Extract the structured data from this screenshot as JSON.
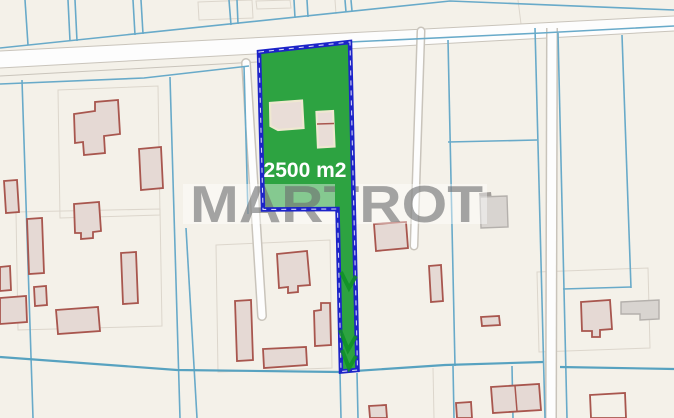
{
  "map": {
    "parcel": {
      "area_label": "2500 m2"
    },
    "watermark": {
      "text": "MARTROT"
    },
    "colors": {
      "background": "#f4f1e9",
      "cadastral_line": "#68aac9",
      "parcel_fill": "#2da341",
      "parcel_border": "#1c23c8",
      "building_fill": "#e5d9d4",
      "building_outline": "#a8564e",
      "road_fill": "#fdfdfd",
      "road_edge": "#c9c4bb",
      "watermark_text": "#6b6c6e",
      "area_label_text": "#ffffff"
    }
  }
}
